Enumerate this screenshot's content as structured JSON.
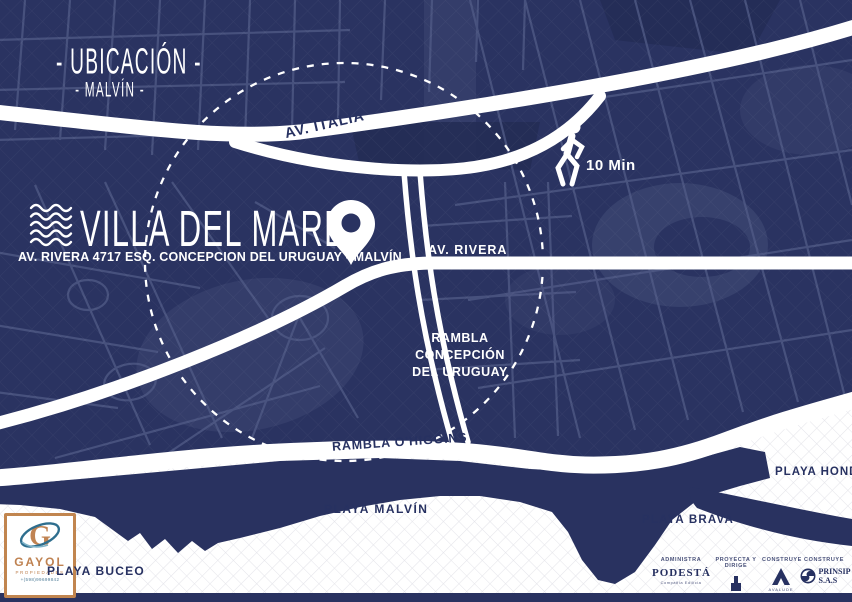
{
  "poster": {
    "section_title": "- UBICACIÓN -",
    "section_subtitle": "- MALVÍN -",
    "project_name": "VILLA DEL MARE",
    "project_address": "AV. RIVERA 4717  ESQ. CONCEPCION DEL URUGUAY - MALVÍN",
    "walk_time": "10 Min"
  },
  "map_labels": {
    "av_italia": "AV. ITALIA",
    "av_rivera": "AV. RIVERA",
    "rambla_concepcion": [
      "RAMBLA",
      "CONCEPCIÓN",
      "DEL URUGUAY"
    ],
    "rambla_ohiggins": "RAMBLA O'HIGGINS",
    "playa_malvin": "PLAYA MALVÍN",
    "playa_brava": "PLAYA BRAVA",
    "playa_honda": "PLAYA HONDA",
    "playa_buceo": "PLAYA BUCEO"
  },
  "agency": {
    "name": "GAYOL",
    "subtitle": "PROPIEDADES",
    "phone": "+(598)99699842"
  },
  "credits": [
    {
      "role": "ADMINISTRA",
      "name": "PODESTÁ",
      "tagline": "Compañía Edilicia"
    },
    {
      "role": "PROYECTA Y DIRIGE",
      "name": "L I B R A I K E N",
      "tagline": "Arquitectos"
    },
    {
      "role": "CONSTRUYE",
      "name": "AVALUDE",
      "tagline": ""
    },
    {
      "role": "CONSTRUYE",
      "name": "PRINSIP S.A.S",
      "tagline": ""
    }
  ],
  "colors": {
    "navy_background": "#2a3361",
    "road_white": "#ffffff",
    "label_navy": "#273161",
    "accent_orange": "#c08352",
    "swoosh_blue": "#2e6e8e",
    "beach_hatch": "#e4e4ea"
  }
}
